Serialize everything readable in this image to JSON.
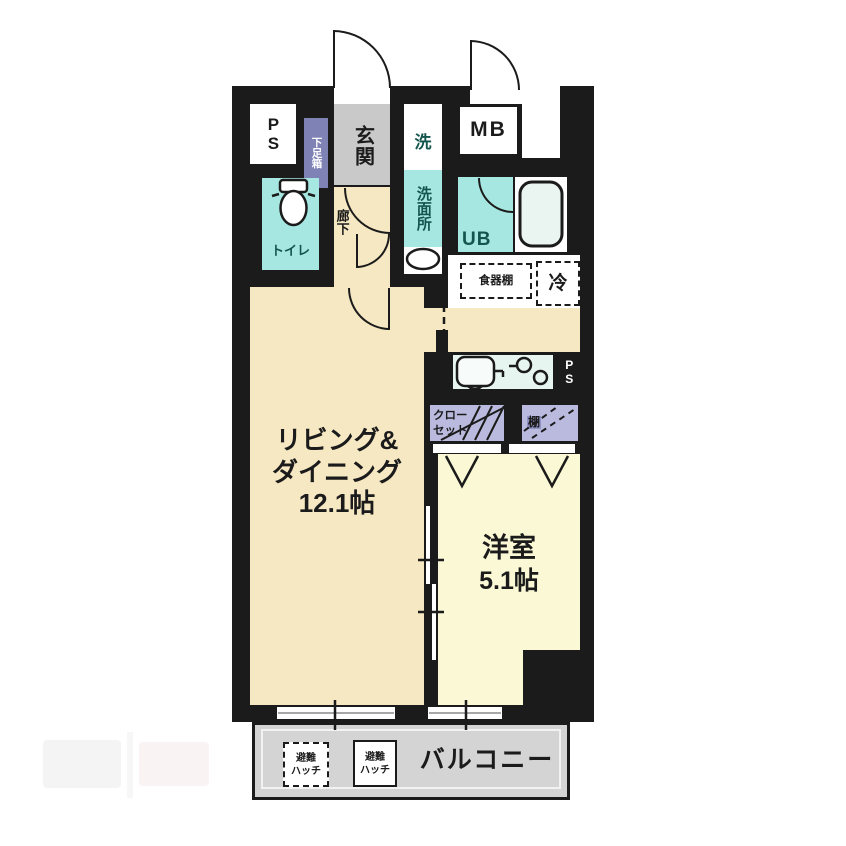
{
  "plan_title": "1LDK floor plan",
  "labels": {
    "ps_top": "PS",
    "shoe_box": "下足箱",
    "entrance": "玄関",
    "hallway": "廊下",
    "laundry": "洗",
    "washroom": "洗面所",
    "meter_box": "MB",
    "unit_bath": "UB",
    "toilet": "トイレ",
    "cupboard": "食器棚",
    "fridge": "冷",
    "ps_kitchen": "PS",
    "closet_l1": "クロー",
    "closet_l2": "セット",
    "shelf": "棚",
    "living_l1": "リビング&",
    "living_l2": "ダイニング",
    "living_size": "12.1帖",
    "western_name": "洋室",
    "western_size": "5.1帖",
    "balcony": "バルコニー",
    "hatch_l1": "避難",
    "hatch_l2": "ハッチ"
  },
  "colors": {
    "wall": "#1b1b1b",
    "floor_cream": "#f6e8c3",
    "floor_pale_yellow": "#fbf8d6",
    "wet_cyan": "#a6e8e1",
    "entrance_gray": "#c9c9c9",
    "balcony_gray": "#d4d4d4",
    "storage_purple_dark": "#7f82b5",
    "storage_purple_light": "#babade",
    "counter_mint": "#e7f5f0",
    "label_teal": "#14564e"
  }
}
